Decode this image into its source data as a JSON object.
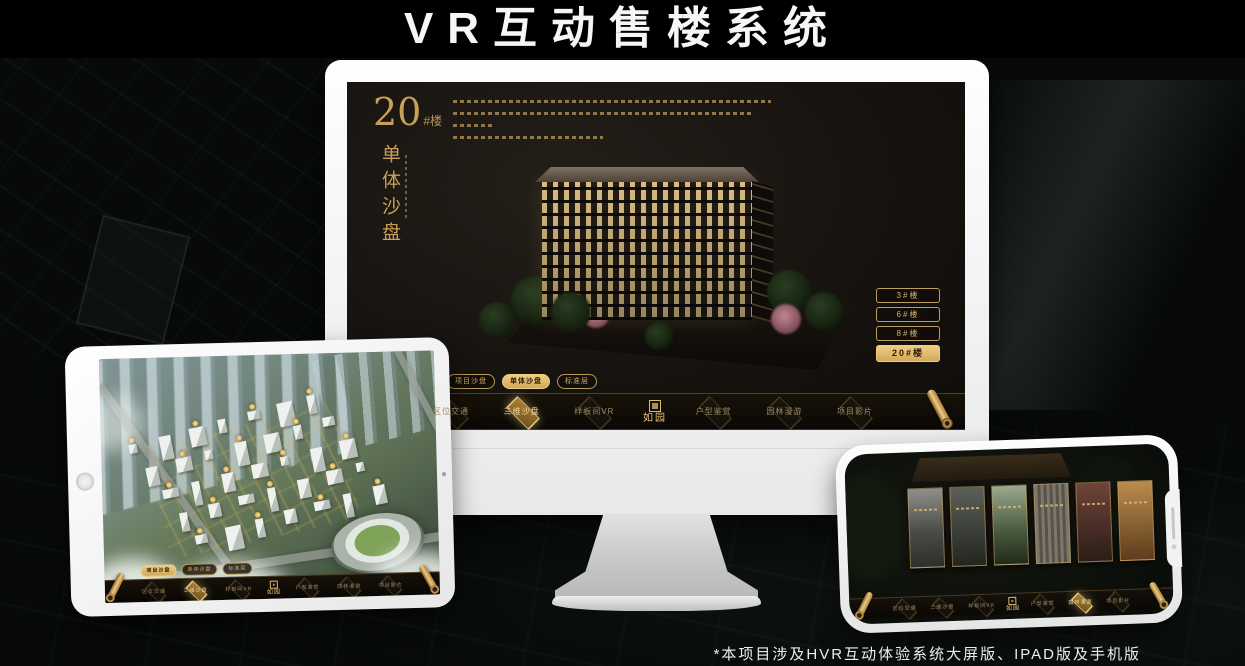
{
  "page_title": "VR互动售楼系统",
  "footnote": "*本项目涉及HVR互动体验系统大屏版、IPAD版及手机版",
  "colors": {
    "gold": "#d2a95f",
    "gold_active_bg": "#e4bd72",
    "screen_dark": "#16120e",
    "title_white": "#f5f5f5"
  },
  "monitor": {
    "block_number": "20",
    "block_suffix": "#楼",
    "section_title_vertical": "单体沙盘",
    "floor_buttons": [
      {
        "label": "3#楼",
        "active": false
      },
      {
        "label": "6#楼",
        "active": false
      },
      {
        "label": "8#楼",
        "active": false
      },
      {
        "label": "20#楼",
        "active": true
      }
    ],
    "view_tabs": [
      {
        "label": "项目沙盘",
        "active": false
      },
      {
        "label": "单体沙盘",
        "active": true
      },
      {
        "label": "标准层",
        "active": false
      }
    ],
    "nav": {
      "logo": "如园",
      "items": [
        {
          "label": "区位交通",
          "active": false
        },
        {
          "label": "三维沙盘",
          "active": true
        },
        {
          "label": "样板间VR",
          "active": false
        },
        {
          "label": "户型鉴赏",
          "active": false
        },
        {
          "label": "园林漫游",
          "active": false
        },
        {
          "label": "项目影片",
          "active": false
        }
      ]
    }
  },
  "tablet": {
    "view_tabs": [
      {
        "label": "项目沙盘",
        "active": true
      },
      {
        "label": "单体沙盘",
        "active": false
      },
      {
        "label": "标准层",
        "active": false
      }
    ],
    "nav": {
      "logo": "如园",
      "items": [
        {
          "label": "区位交通",
          "active": false
        },
        {
          "label": "三维沙盘",
          "active": true
        },
        {
          "label": "样板间VR",
          "active": false
        },
        {
          "label": "户型鉴赏",
          "active": false
        },
        {
          "label": "园林漫游",
          "active": false
        },
        {
          "label": "项目影片",
          "active": false
        }
      ]
    }
  },
  "phone": {
    "gallery_card_count": 6,
    "nav": {
      "logo": "如园",
      "items": [
        {
          "label": "区位交通",
          "active": false
        },
        {
          "label": "三维沙盘",
          "active": false
        },
        {
          "label": "样板间VR",
          "active": false
        },
        {
          "label": "户型鉴赏",
          "active": false
        },
        {
          "label": "园林漫游",
          "active": true
        },
        {
          "label": "项目影片",
          "active": false
        }
      ]
    }
  }
}
